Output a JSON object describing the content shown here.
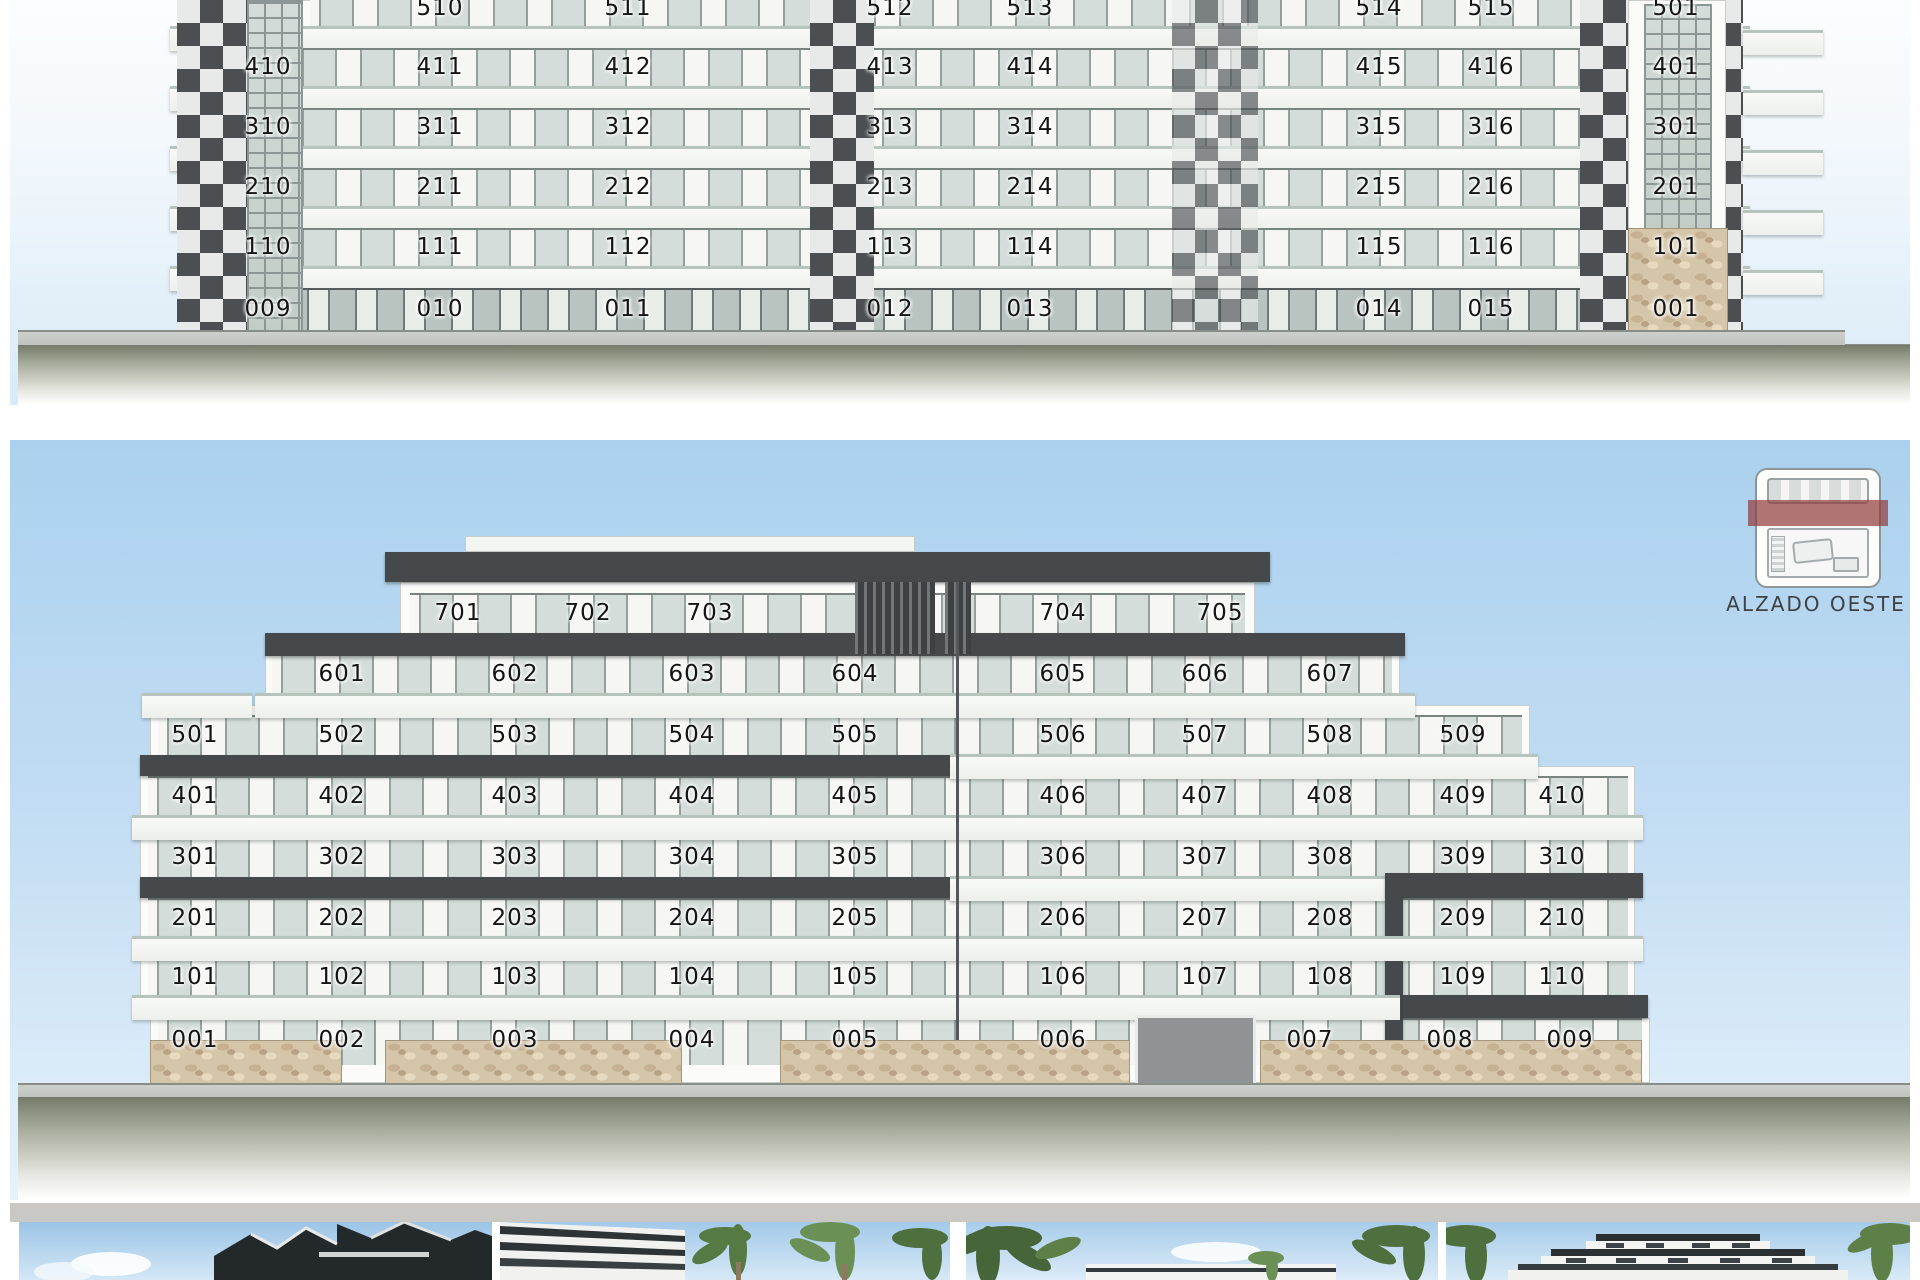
{
  "elevation1": {
    "rows": [
      {
        "floor": "5",
        "units": [
          "510",
          "511",
          "512",
          "513",
          "514",
          "515",
          "501"
        ]
      },
      {
        "floor": "4",
        "units": [
          "410",
          "411",
          "412",
          "413",
          "414",
          "415",
          "416",
          "401"
        ]
      },
      {
        "floor": "3",
        "units": [
          "310",
          "311",
          "312",
          "313",
          "314",
          "315",
          "316",
          "301"
        ]
      },
      {
        "floor": "2",
        "units": [
          "210",
          "211",
          "212",
          "213",
          "214",
          "215",
          "216",
          "201"
        ]
      },
      {
        "floor": "1",
        "units": [
          "110",
          "111",
          "112",
          "113",
          "114",
          "115",
          "116",
          "101"
        ]
      },
      {
        "floor": "0",
        "units": [
          "009",
          "010",
          "011",
          "012",
          "013",
          "014",
          "015",
          "001"
        ]
      }
    ]
  },
  "elevation_west": {
    "label": "ALZADO OESTE",
    "rows": [
      {
        "floor": "7",
        "units": [
          "701",
          "702",
          "703",
          "704",
          "705"
        ]
      },
      {
        "floor": "6",
        "units": [
          "601",
          "602",
          "603",
          "604",
          "605",
          "606",
          "607"
        ]
      },
      {
        "floor": "5",
        "units": [
          "501",
          "502",
          "503",
          "504",
          "505",
          "506",
          "507",
          "508",
          "509"
        ]
      },
      {
        "floor": "4",
        "units": [
          "401",
          "402",
          "403",
          "404",
          "405",
          "406",
          "407",
          "408",
          "409",
          "410"
        ]
      },
      {
        "floor": "3",
        "units": [
          "301",
          "302",
          "303",
          "304",
          "305",
          "306",
          "307",
          "308",
          "309",
          "310"
        ]
      },
      {
        "floor": "2",
        "units": [
          "201",
          "202",
          "203",
          "204",
          "205",
          "206",
          "207",
          "208",
          "209",
          "210"
        ]
      },
      {
        "floor": "1",
        "units": [
          "101",
          "102",
          "103",
          "104",
          "105",
          "106",
          "107",
          "108",
          "109",
          "110"
        ]
      },
      {
        "floor": "0",
        "units": [
          "001",
          "002",
          "003",
          "004",
          "005",
          "006",
          "007",
          "008",
          "009"
        ]
      }
    ]
  },
  "colors": {
    "dark_slab": "#45494b",
    "stone": "#d6c6a9",
    "key_band_red": "#92403e",
    "sky_top": "#abd1ee"
  },
  "thumbnails": [
    {
      "name": "render-corner-view"
    },
    {
      "name": "render-side-view"
    },
    {
      "name": "render-garden-view"
    },
    {
      "name": "render-front-view"
    }
  ]
}
